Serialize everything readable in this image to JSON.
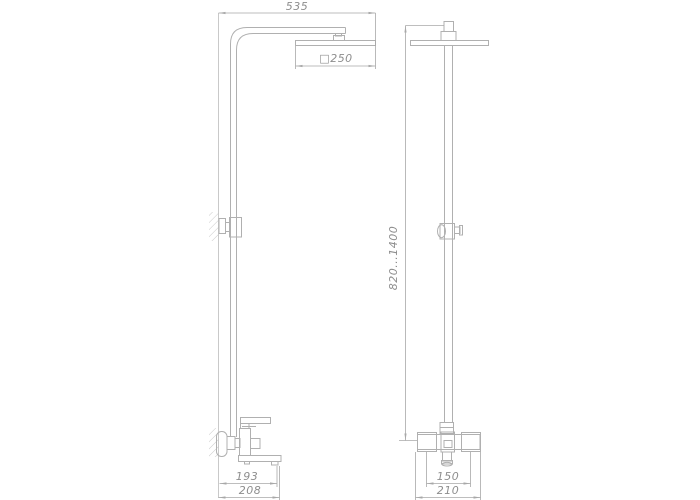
{
  "drawing": {
    "type": "technical-drawing-shower-column",
    "background_color": "#ffffff",
    "line_color": "#b0b0b0",
    "text_color": "#8e8e8e",
    "views": [
      {
        "name": "side-view",
        "position": "left"
      },
      {
        "name": "front-view",
        "position": "right"
      }
    ],
    "dimensions": {
      "overall_width_top": "535",
      "head_size": "□250",
      "height_range": "820...1400",
      "spout_reach": "193",
      "overall_depth": "208",
      "inlet_spacing": "150",
      "mixer_width": "210"
    }
  }
}
